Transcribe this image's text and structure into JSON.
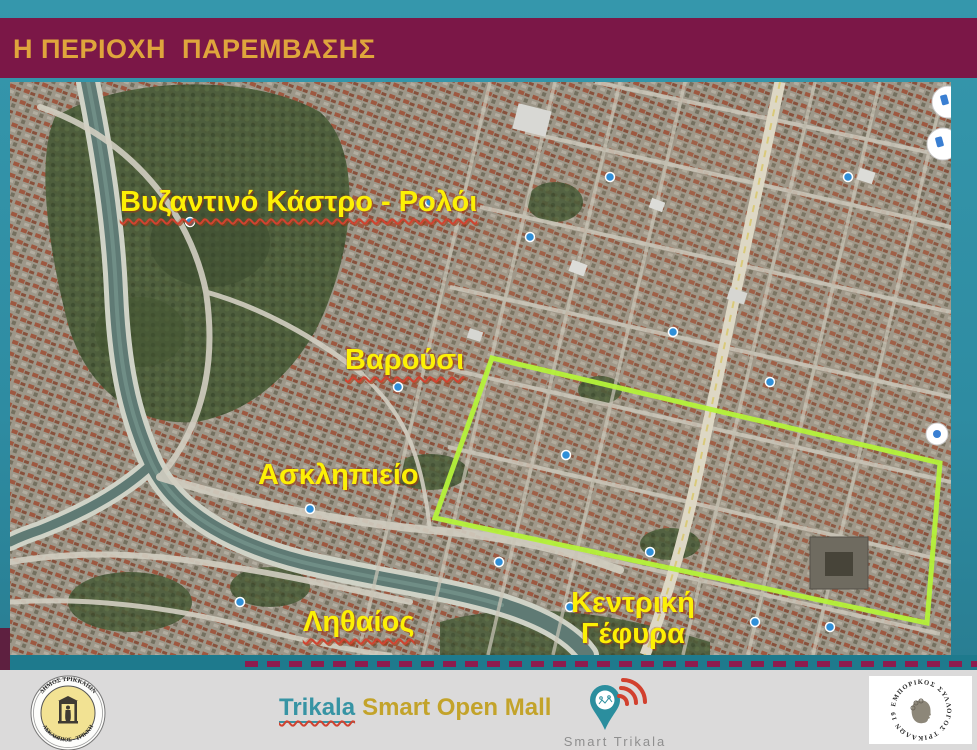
{
  "slide": {
    "title": "Η ΠΕΡΙΟΧΗ  ΠΑΡΕΜΒΑΣΗΣ"
  },
  "colors": {
    "background_teal": "#2E8CA4",
    "title_bar_maroon": "#7B1747",
    "title_gold": "#DFA53C",
    "map_label_yellow": "#FCF005",
    "intervention_outline_green": "#B5F23A",
    "dashed_line_maroon": "#8D1C4E",
    "footer_gray": "#DBDADA",
    "brand_teal": "#3794A4",
    "brand_gold": "#C3A32A"
  },
  "map": {
    "type": "satellite-aerial",
    "labels": {
      "byzantine_castle": "Βυζαντινό Κάστρο - Ρολόι",
      "varousi": "Βαρούσι",
      "asklipieio": "Ασκληπιείο",
      "lithaios": "Ληθαίος",
      "central_bridge_line1": "Κεντρική",
      "central_bridge_line2": "Γέφυρα"
    },
    "annotations": {
      "intervention_area": "green polygon outline over the commercial center"
    }
  },
  "footer": {
    "municipal_seal_top": "ΔΗΜΟΣ ΤΡΙΚΚΑΙΩΝ",
    "municipal_seal_bottom": "ΑΣΚΛΗΠΙΟΣ - ΤΡΙΚΚΗ",
    "brand_city": "Trikala",
    "brand_rest": "Smart Open Mall",
    "smart_trikala_caption": "Smart Trikala",
    "commerce_seal_text": "ΕΜΠΟΡΙΚΟΣ ΣΥΛΛΟΓΟΣ ΤΡΙΚΑΛΩΝ 1908",
    "icons": {
      "municipal_seal": "asklepios-statue-seal-icon",
      "smart_trikala": "map-pin-wifi-icon",
      "commerce_seal": "classical-head-seal-icon"
    }
  }
}
